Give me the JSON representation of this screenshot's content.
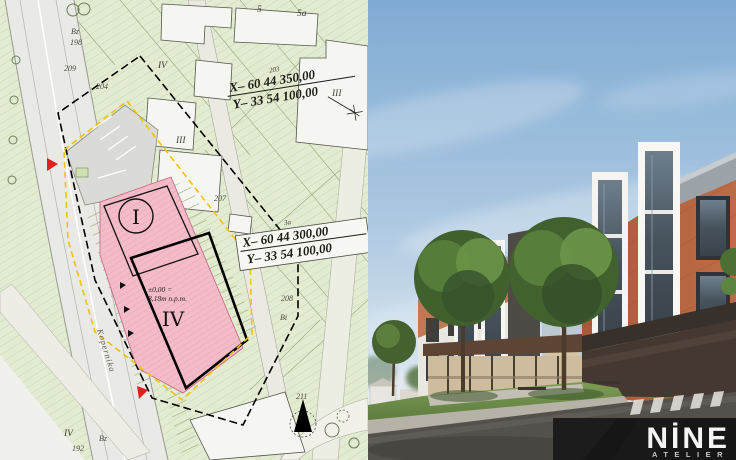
{
  "map": {
    "coord_top": {
      "parcel": "203",
      "x": "X– 60 44 350,00",
      "y": "Y– 33 54 100,00"
    },
    "coord_bottom": {
      "parcel": "3a",
      "x": "X– 60 44 300,00",
      "y": "Y– 33 54 100,00"
    },
    "plot_i": "I",
    "plot_iv": "IV",
    "elevation": {
      "line1": "±0,00 =",
      "line2": "8,18m n.p.m."
    },
    "street": "Kopernika",
    "labels": {
      "bldg5": "5",
      "bldg5a": "5a",
      "roman4_top": "IV",
      "roman3_mid": "III",
      "roman3_right": "III",
      "p204": "204",
      "p207": "207",
      "p208": "208",
      "p209": "209",
      "p211": "211",
      "p198": "198",
      "p192": "192",
      "bi": "Bi",
      "bz_top": "Bz",
      "bz_bottom": "Bz",
      "roman4_bottom": "IV"
    },
    "colors": {
      "site_pink": "#f3bcc8",
      "boundary_yellow": "#f2c300",
      "map_green": "#e3ecd2"
    }
  },
  "render": {
    "colors": {
      "sky": "#8cb4d8",
      "brick": "#b5653f",
      "grass": "#5f7c3e",
      "asphalt": "#54504c"
    }
  },
  "logo": {
    "name": "NİNE",
    "tagline": "ATELIER"
  }
}
